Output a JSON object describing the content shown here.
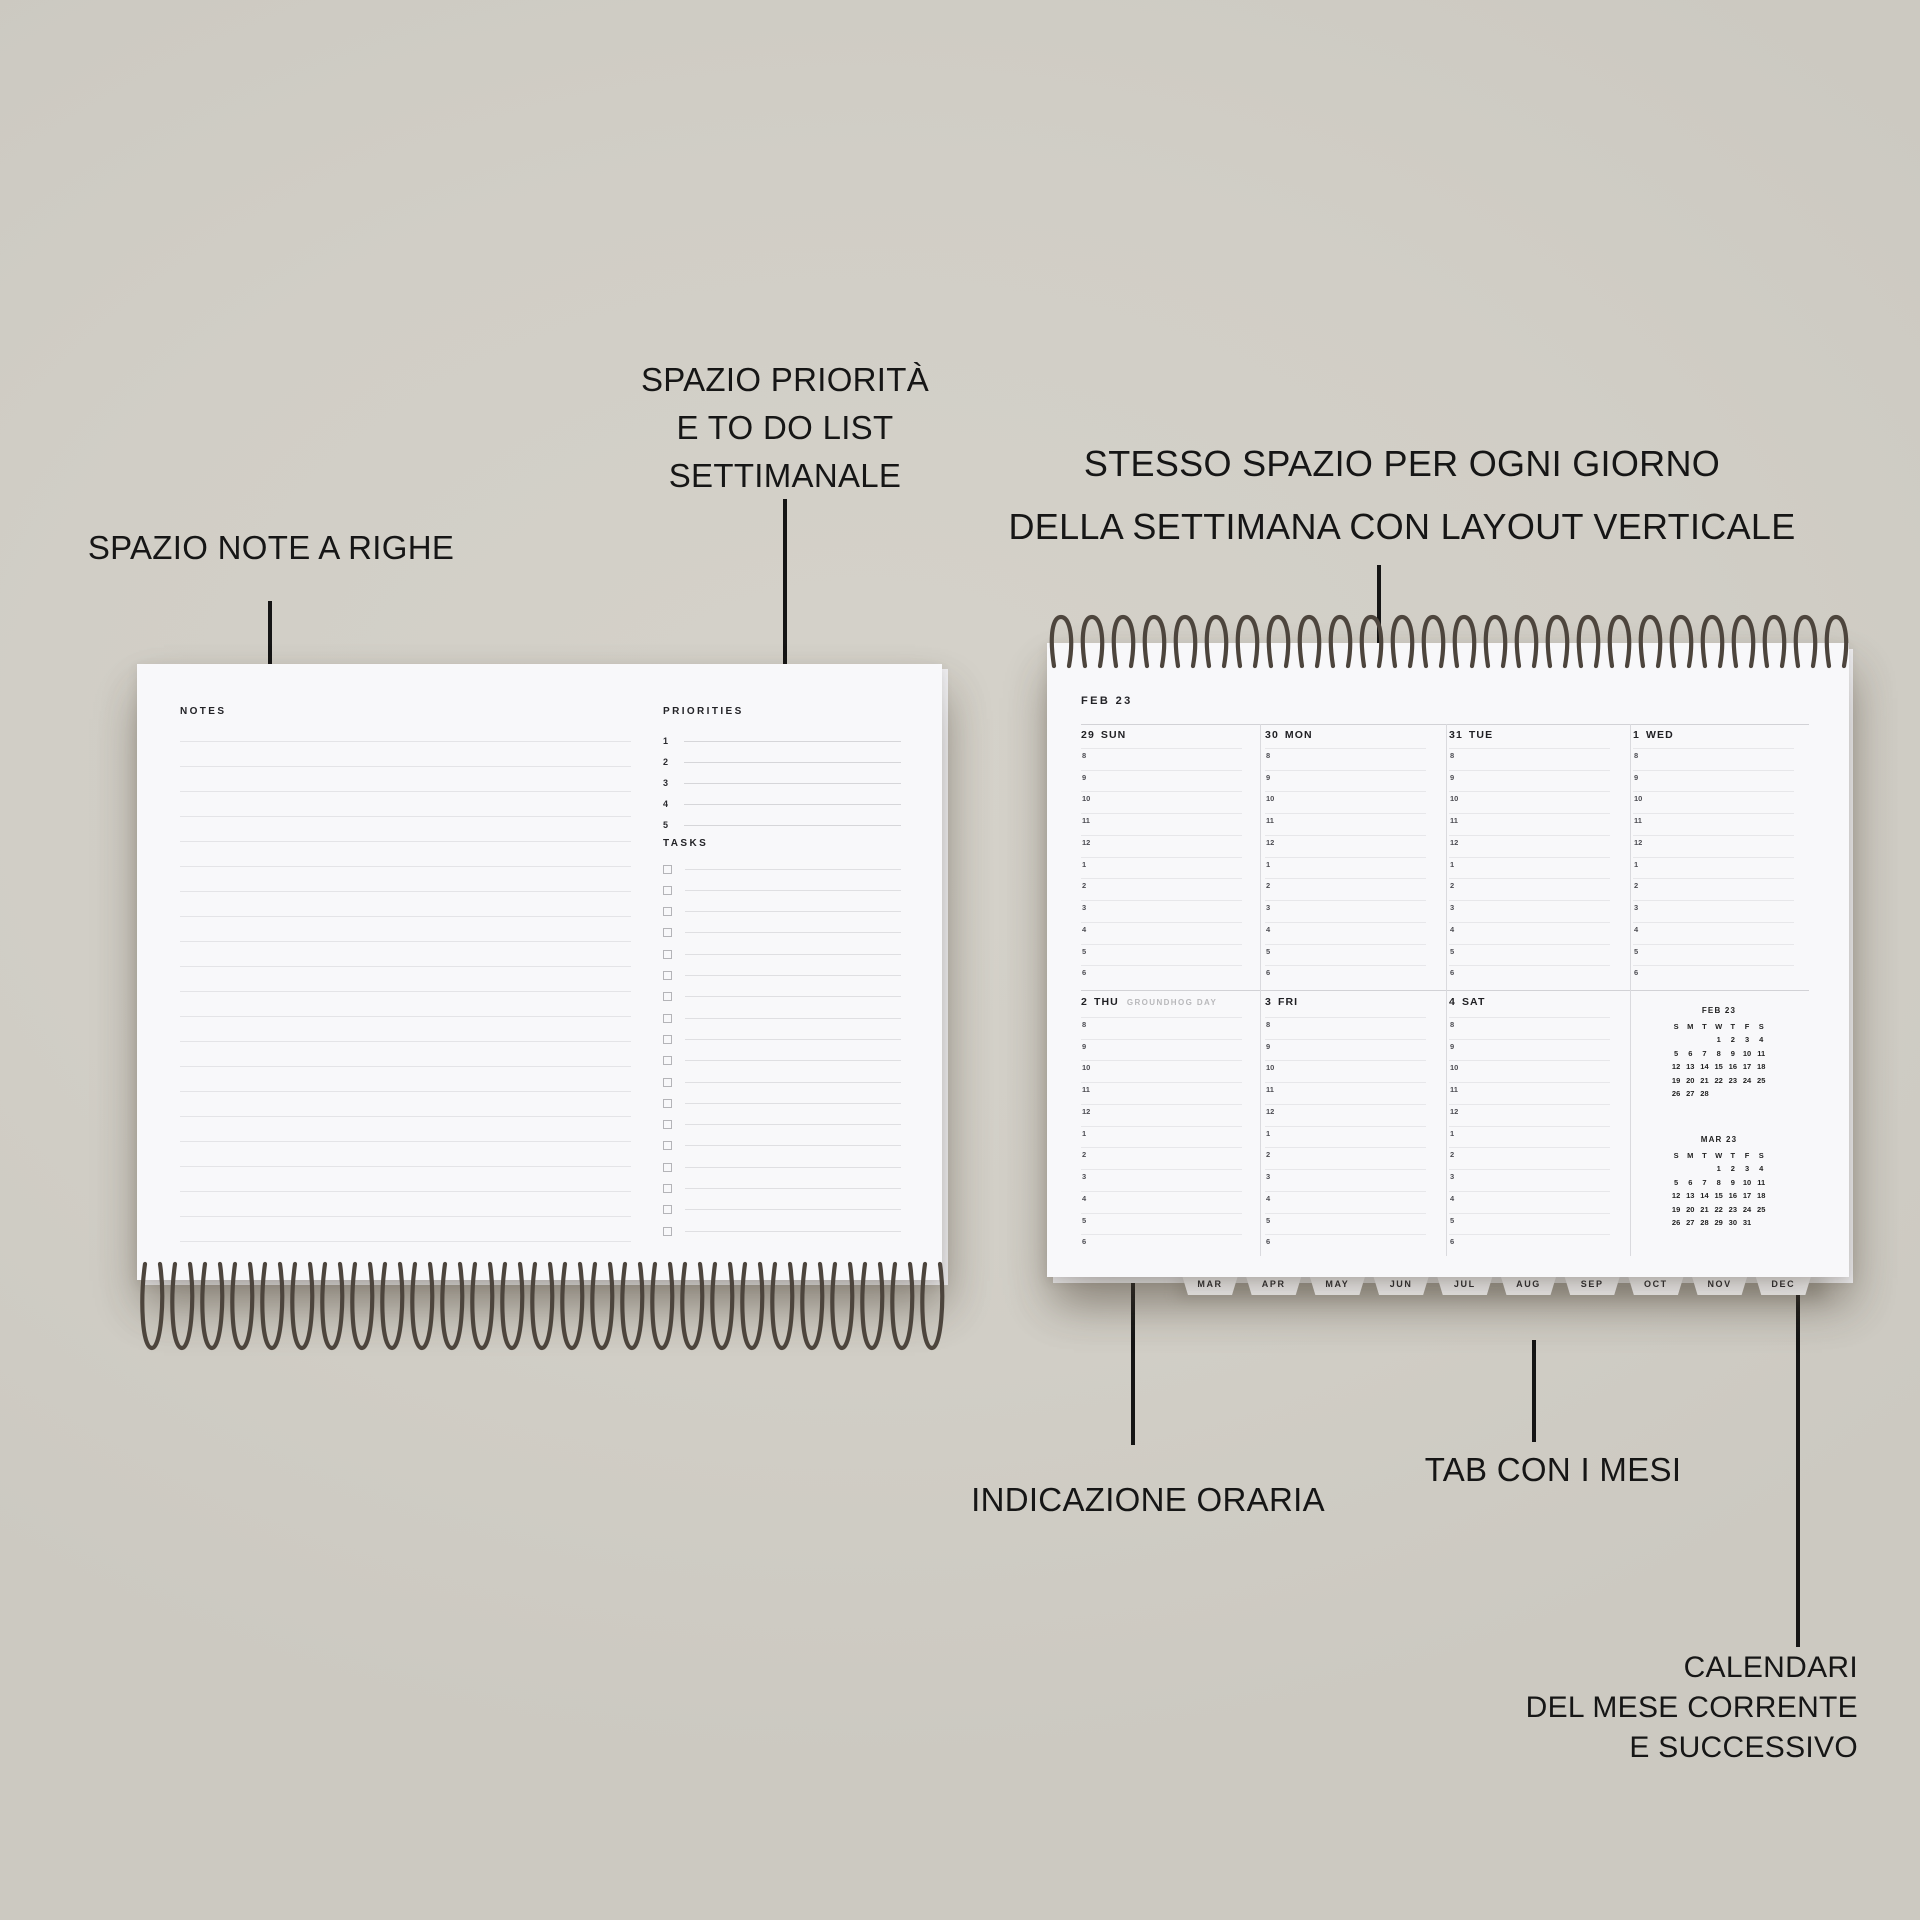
{
  "annotations": {
    "notes": "SPAZIO NOTE A RIGHE",
    "priorities": [
      "SPAZIO PRIORITÀ",
      "E TO DO LIST",
      "SETTIMANALE"
    ],
    "vertical_layout": [
      "STESSO SPAZIO PER OGNI GIORNO",
      "DELLA SETTIMANA CON LAYOUT VERTICALE"
    ],
    "hours": "INDICAZIONE ORARIA",
    "tabs": "TAB CON I MESI",
    "calendars": [
      "CALENDARI",
      "DEL MESE CORRENTE",
      "E SUCCESSIVO"
    ]
  },
  "notepad": {
    "notes_label": "NOTES",
    "priorities_label": "PRIORITIES",
    "priority_numbers": [
      "1",
      "2",
      "3",
      "4",
      "5"
    ],
    "tasks_label": "TASKS",
    "task_rows": 18,
    "note_lines": 21
  },
  "planner": {
    "title": "FEB 23",
    "hours": [
      "8",
      "9",
      "10",
      "11",
      "12",
      "1",
      "2",
      "3",
      "4",
      "5",
      "6"
    ],
    "week1": [
      {
        "num": "29",
        "name": "SUN"
      },
      {
        "num": "30",
        "name": "MON"
      },
      {
        "num": "31",
        "name": "TUE"
      },
      {
        "num": "1",
        "name": "WED"
      }
    ],
    "week2": [
      {
        "num": "2",
        "name": "THU",
        "note": "GROUNDHOG DAY"
      },
      {
        "num": "3",
        "name": "FRI"
      },
      {
        "num": "4",
        "name": "SAT"
      }
    ],
    "month_tabs": [
      "MAR",
      "APR",
      "MAY",
      "JUN",
      "JUL",
      "AUG",
      "SEP",
      "OCT",
      "NOV",
      "DEC"
    ],
    "mini_calendars": [
      {
        "title": "FEB 23",
        "dow": [
          "S",
          "M",
          "T",
          "W",
          "T",
          "F",
          "S"
        ],
        "weeks": [
          [
            "",
            "",
            "",
            "1",
            "2",
            "3",
            "4"
          ],
          [
            "5",
            "6",
            "7",
            "8",
            "9",
            "10",
            "11"
          ],
          [
            "12",
            "13",
            "14",
            "15",
            "16",
            "17",
            "18"
          ],
          [
            "19",
            "20",
            "21",
            "22",
            "23",
            "24",
            "25"
          ],
          [
            "26",
            "27",
            "28",
            "",
            "",
            "",
            ""
          ]
        ]
      },
      {
        "title": "MAR 23",
        "dow": [
          "S",
          "M",
          "T",
          "W",
          "T",
          "F",
          "S"
        ],
        "weeks": [
          [
            "",
            "",
            "",
            "1",
            "2",
            "3",
            "4"
          ],
          [
            "5",
            "6",
            "7",
            "8",
            "9",
            "10",
            "11"
          ],
          [
            "12",
            "13",
            "14",
            "15",
            "16",
            "17",
            "18"
          ],
          [
            "19",
            "20",
            "21",
            "22",
            "23",
            "24",
            "25"
          ],
          [
            "26",
            "27",
            "28",
            "29",
            "30",
            "31",
            ""
          ]
        ]
      }
    ]
  },
  "colors": {
    "background": "#d1cec6",
    "page": "#f8f8fa",
    "ink": "#1e1e22",
    "muted_text": "#b8b8bb",
    "wire": "#4d453d",
    "annotation": "#161616"
  }
}
